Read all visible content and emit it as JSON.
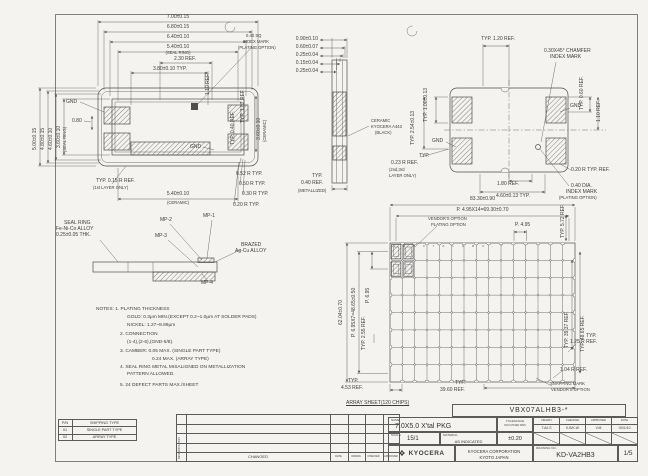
{
  "sheet": {
    "bg": "#f4f3ef",
    "line": "#4e4e4e",
    "text": "#3d3d3d"
  },
  "top_view": {
    "h_dims": [
      "7.00±0.15",
      "6.80±0.15",
      "6.40±0.10",
      "5.40±0.10",
      "(SEAL RING)",
      "2.30 REF.",
      "3.80±0.10 TYP."
    ],
    "v_dims": [
      "5.00±0.15",
      "4.80±0.15",
      "4.60±0.10",
      "3.60±0.10",
      "(SEAL RING)",
      "0.80"
    ],
    "gnd": "GND",
    "index_mark": [
      "0.40 SQ",
      "INDEX MARK",
      "(PLATING OPTION)"
    ],
    "right_dims": [
      "1.10 REF.",
      "TYP. 1.02 REF.",
      "TYP. 0.40 REF.",
      "3.60±0.10",
      "(CERAMIC)"
    ],
    "radius": [
      "0.52 R TYP.",
      "0.50 R TYP.",
      "0.30 R TYP.",
      "0.20 R TYP."
    ],
    "layer_note": [
      "TYP. 0.15 R REF.",
      "(1st LAYER ONLY)"
    ],
    "bottom_dim": [
      "5.40±0.10",
      "(CERAMIC)"
    ]
  },
  "side_view": {
    "dims": [
      "0.90±0.10",
      "0.60±0.07",
      "0.25±0.04",
      "0.15±0.04",
      "0.25±0.04"
    ],
    "material": [
      "CERAMIC",
      "KYOCERA A443",
      "(BLACK)"
    ],
    "metallized": [
      "TYP.",
      "0.40 REF.",
      "(METALLIZED)"
    ]
  },
  "bottom_view": {
    "typ_120": "TYP. 1.20 REF.",
    "typ_100": "TYP. 1.00±0.13",
    "chamfer": [
      "0.30X45° CHAMFER",
      "INDEX MARK"
    ],
    "typ_060": "TYP. 0.60 REF.",
    "gnd": "GND",
    "ref_110": "1.10 REF.",
    "typ_254": "TYP. 2.54±0.13",
    "layer_note": [
      "TYP.",
      "0.23 R REF.",
      "(2nd,3rd",
      "LAYER ONLY)"
    ],
    "ref_180": "1.80 REF.",
    "dim_460": "4.60±0.13 TYP.",
    "r_020": "0.20 R TYP. REF.",
    "index_mark": [
      "0.40 DIA.",
      "INDEX MARK",
      "(PLATING OPTION)"
    ]
  },
  "seal_detail": {
    "callout": [
      "SEAL RING",
      "Fe-Ni-Co ALLOY",
      "0.25±0.05 THK."
    ],
    "mp1": "MP-1",
    "mp2": "MP-2",
    "mp3": "MP-3",
    "mp4": "MP-4",
    "brazed": [
      "BRAZED",
      "Ag-Cu ALLOY"
    ]
  },
  "notes": {
    "lines": [
      "NOTES: 1.  PLATING THICKNESS",
      "GOLD:  0.3μm MIN.(EXCEPT 0.2~1.0μm AT SOLDER PADS)",
      "NICKEL:  1.27~8.89μm",
      "2.  CONNECTION",
      "(1-4),(2-6),(GND-5/8).",
      "3.  CAMBER:  0.05 MAX.  (SINGLE PART TYPE)",
      "0.24 MAX.  (ARRAY TYPE)",
      "4.  SEAL RING METAL MISALIGNED ON METALLIZATION",
      "PATTERN ALLOWED.",
      "5.  24 DEFECT PARTS MAX./SHEET"
    ]
  },
  "array_sheet": {
    "dim_w": "83.30±0.90",
    "pitch_w": "P. 4.95X14=69.30±0.70",
    "vendors": [
      "VENDOR'S OPTION",
      "PLATING OPTION"
    ],
    "p_495": "P. 4.95",
    "dim_h": "62.04±0.70",
    "pitch_h": "P. 6.95X7=48.65±0.50",
    "p_695": "P. 6.95",
    "typ_255": "TYP. 2.55 REF.",
    "typ_453": [
      "TYP.",
      "4.53 REF."
    ],
    "typ_3960": [
      "TYP.",
      "39.60 REF."
    ],
    "caption": "ARRAY SHEET(120 CHIPS)",
    "typ_572": "TYP. 5.72 REF.",
    "typ_3937": "TYP. 39.37 REF.",
    "typ_4865": "TYP. 48.65 REF.",
    "r_125": [
      "TYP.",
      "1.25 R REF."
    ],
    "r_104": "1.04 R REF.",
    "snapping": [
      "SNAPPING MARK",
      "VENDOR'S OPTION"
    ],
    "chip_marks": "VBX07ALHB3-*"
  },
  "pn_table": {
    "rows": [
      [
        "P/N",
        "SHIPPING TYPE"
      ],
      [
        "01",
        "SINGLE PART TYPE"
      ],
      [
        "02",
        "ARRAY TYPE"
      ]
    ]
  },
  "revision": {
    "modification": "MODIFICATION",
    "changed": "CHANGED",
    "cols": [
      "DATE",
      "DRAWN",
      "CHECKED",
      "APPROVED"
    ]
  },
  "title_block": {
    "part_no": "VBX07ALHB3-*",
    "name_label": "NAME",
    "name": "7.0X5.0 X'tal PKG",
    "scale_label": "SCALE",
    "scale": "15/1",
    "material_label": "MATERIAL",
    "material": "AS INDICATED",
    "tolerance_label": "TOLERANCE",
    "tolerance_sub": "NON STATED DIMS",
    "tolerance": "±0.20",
    "sign_cols": [
      "DRAWN",
      "CHECKED",
      "APPROVED",
      "DATE"
    ],
    "sign_vals": [
      "T.A/I.S",
      "K.B/K.W",
      "V.M",
      "'00/1/10"
    ],
    "brand": "KYOCERA",
    "company": [
      "KYOCERA CORPORATION",
      "KYOTO JAPAN"
    ],
    "drawing_no_label": "DRAWING NO.",
    "drawing_no": "KD-VA2HB3",
    "sheet": "1/5"
  }
}
